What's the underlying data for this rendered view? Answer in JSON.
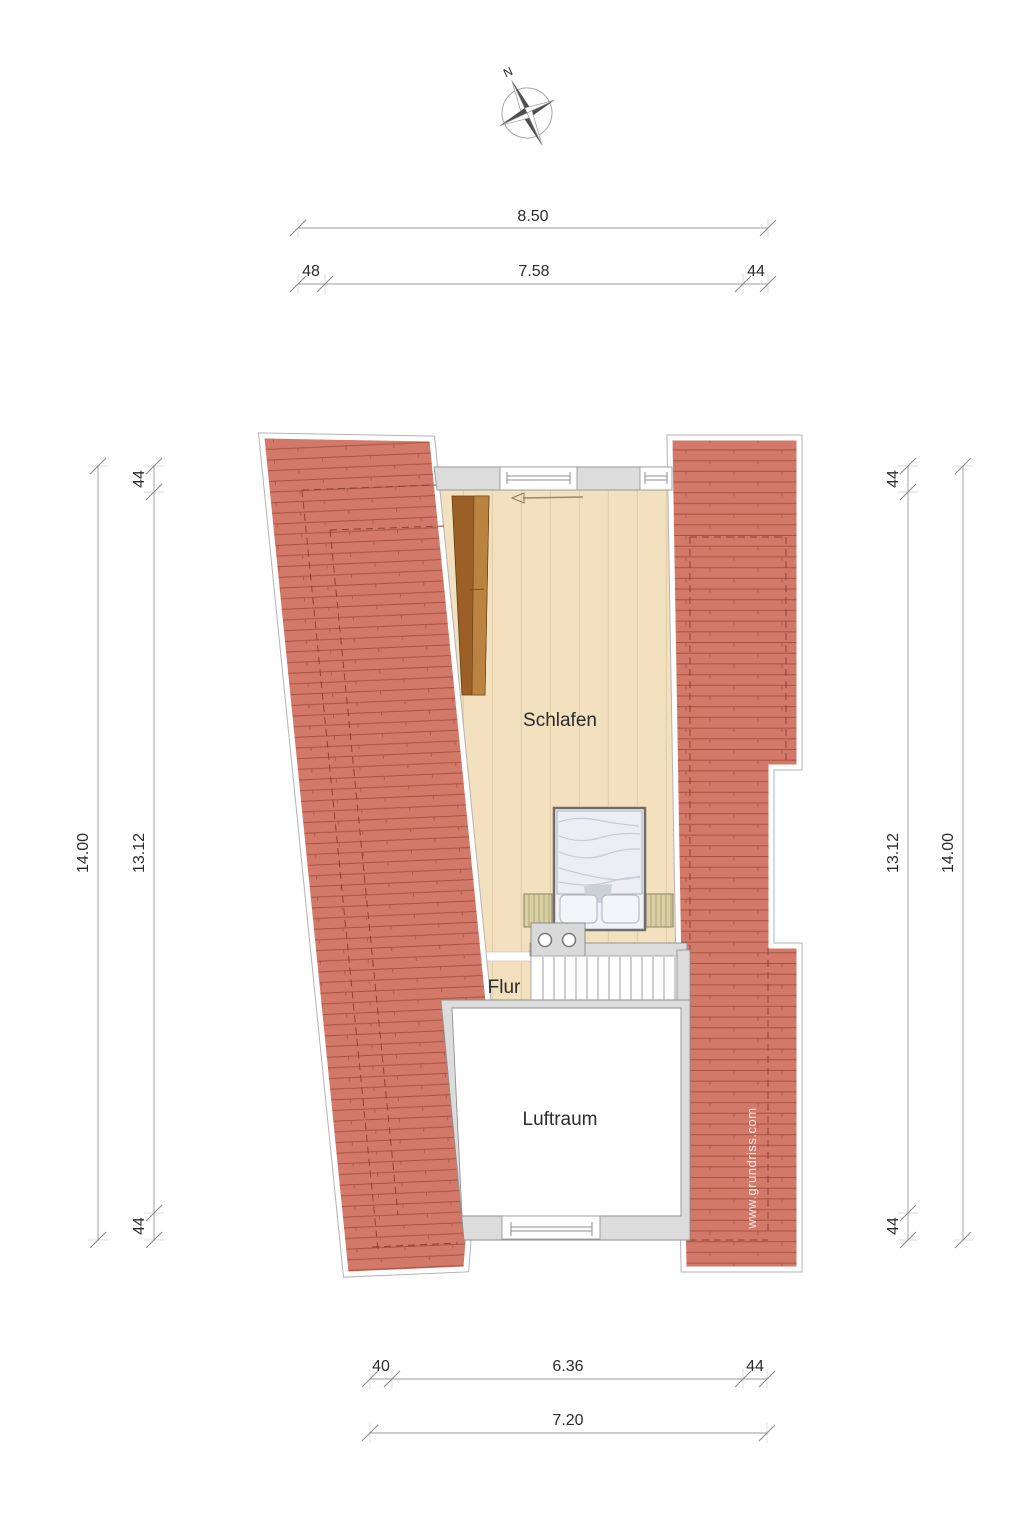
{
  "compass": {
    "north_label": "N"
  },
  "rooms": {
    "schlafen": "Schlafen",
    "flur": "Flur",
    "luftraum": "Luftraum"
  },
  "dimensions": {
    "top": {
      "overall": "8.50",
      "segments": [
        "48",
        "7.58",
        "44"
      ]
    },
    "bottom": {
      "overall": "7.20",
      "segments": [
        "40",
        "6.36",
        "44"
      ]
    },
    "left": {
      "overall": "14.00",
      "segments": [
        "44",
        "13.12",
        "44"
      ]
    },
    "right": {
      "overall": "14.00",
      "segments": [
        "44",
        "13.12",
        "44"
      ]
    }
  },
  "watermark": {
    "text": "www.grundriss.com"
  },
  "colors": {
    "roof_fill": "#d3796a",
    "roof_line": "#a8523f",
    "roof_dash": "#8d4033",
    "floor_fill": "#f3e0bf",
    "floor_line": "#e4cfab",
    "wall_fill": "#dcdcdc",
    "wardrobe_dark": "#9c6026",
    "wardrobe_light": "#bb8340"
  }
}
